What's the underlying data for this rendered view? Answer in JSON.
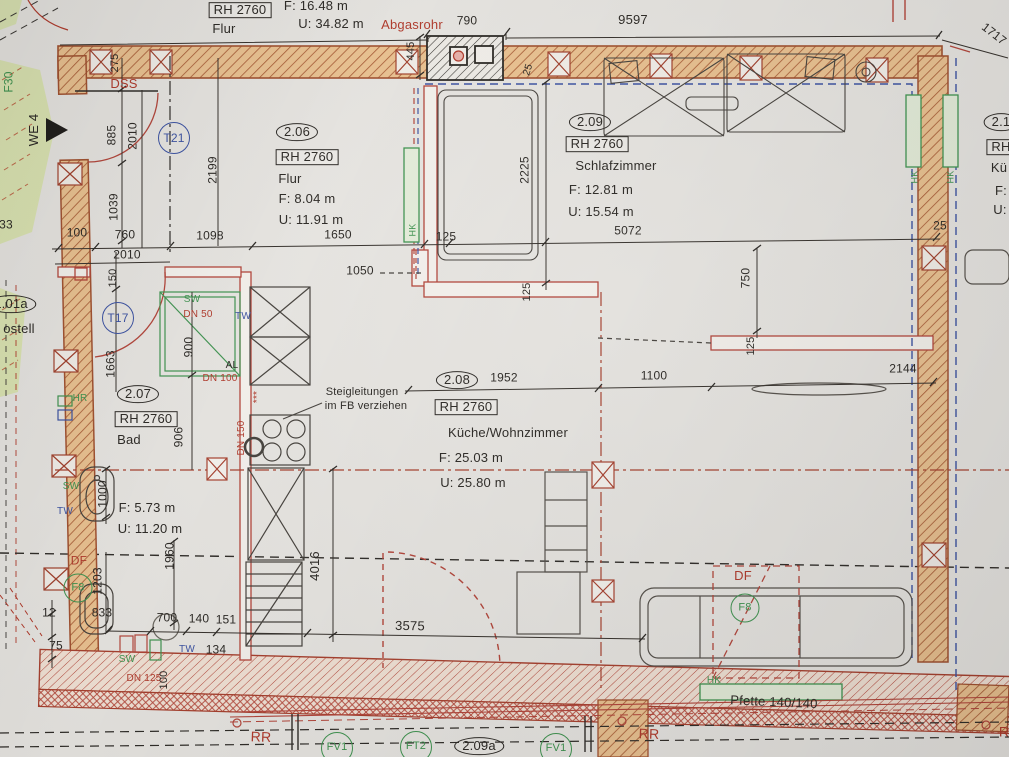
{
  "title": "Grundriss Wohnung WE 4 — Obergeschoss Ausschnitt",
  "colors": {
    "black": "#2b2824",
    "red": "#b23a2b",
    "green": "#3f9450",
    "blue": "#3b52a3",
    "wallFill": "#ecc391",
    "wallStroke": "#a2512f",
    "bandFill": "#f3e3d6",
    "paper": "#e9e7e3",
    "greenArea": "#dbe5ad",
    "pink": "#eab3ab"
  },
  "rooms": [
    {
      "number": "2.06",
      "rh": "RH 2760",
      "name": "Flur",
      "area": "F: 8.04 m",
      "perimeter": "U: 11.91 m"
    },
    {
      "number": "2.07",
      "rh": "RH 2760",
      "name": "Bad",
      "area": "F: 5.73 m",
      "perimeter": "U: 11.20 m"
    },
    {
      "number": "2.08",
      "rh": "RH 2760",
      "name": "Küche/Wohnzimmer",
      "area": "F: 25.03 m",
      "perimeter": "U: 25.80 m"
    },
    {
      "number": "2.09",
      "rh": "RH 2760",
      "name": "Schlafzimmer",
      "area": "F: 12.81 m",
      "perimeter": "U: 15.54 m"
    }
  ],
  "labels": [
    {
      "n": "top-flur-rh",
      "t": "RH 2760",
      "x": 240,
      "y": 10,
      "s": 13,
      "st": "box",
      "c": "black"
    },
    {
      "n": "top-flur-name",
      "t": "Flur",
      "x": 224,
      "y": 29,
      "s": 13,
      "c": "black"
    },
    {
      "n": "top-flur-area",
      "t": "F: 16.48 m",
      "x": 316,
      "y": 6,
      "s": 13,
      "c": "black"
    },
    {
      "n": "top-flur-perimeter",
      "t": "U: 34.82 m",
      "x": 331,
      "y": 24,
      "s": 13,
      "c": "black"
    },
    {
      "n": "abgasrohr-label",
      "t": "Abgasrohr",
      "x": 412,
      "y": 25,
      "s": 13,
      "c": "red"
    },
    {
      "n": "dim-790",
      "t": "790",
      "x": 467,
      "y": 21,
      "s": 12,
      "c": "black"
    },
    {
      "n": "dim-9597",
      "t": "9597",
      "x": 633,
      "y": 20,
      "s": 13,
      "c": "black"
    },
    {
      "n": "dim-1717",
      "t": "1717",
      "x": 994,
      "y": 34,
      "s": 12,
      "r": 38,
      "c": "black"
    },
    {
      "n": "dim-445",
      "t": "445",
      "x": 412,
      "y": 51,
      "s": 11,
      "r": -90,
      "c": "black"
    },
    {
      "n": "dim-25-chimney",
      "t": "25",
      "x": 529,
      "y": 70,
      "s": 10,
      "r": -72,
      "c": "black"
    },
    {
      "n": "dss-label",
      "t": "DSS",
      "x": 124,
      "y": 84,
      "s": 13,
      "c": "red"
    },
    {
      "n": "f30-label",
      "t": "F30",
      "x": 9,
      "y": 82,
      "s": 12,
      "r": -90,
      "c": "green"
    },
    {
      "n": "we4-label",
      "t": "WE 4",
      "x": 34,
      "y": 130,
      "s": 13,
      "r": -90,
      "c": "black"
    },
    {
      "n": "door-tag-t21",
      "t": "T21",
      "x": 174,
      "y": 138,
      "s": 12,
      "st": "circ",
      "c": "blue"
    },
    {
      "n": "dim-275",
      "t": "275",
      "x": 116,
      "y": 63,
      "s": 11,
      "r": -90,
      "c": "black"
    },
    {
      "n": "dim-885",
      "t": "885",
      "x": 112,
      "y": 135,
      "s": 12,
      "r": -90,
      "c": "black"
    },
    {
      "n": "dim-2010-v",
      "t": "2010",
      "x": 133,
      "y": 136,
      "s": 12,
      "r": -90,
      "c": "black"
    },
    {
      "n": "dim-1039",
      "t": "1039",
      "x": 114,
      "y": 207,
      "s": 12,
      "r": -90,
      "c": "black"
    },
    {
      "n": "dim-2199",
      "t": "2199",
      "x": 213,
      "y": 170,
      "s": 12,
      "r": -90,
      "c": "black"
    },
    {
      "n": "dim-100",
      "t": "100",
      "x": 77,
      "y": 233,
      "s": 12,
      "c": "black"
    },
    {
      "n": "dim-760",
      "t": "760",
      "x": 125,
      "y": 235,
      "s": 12,
      "c": "black"
    },
    {
      "n": "dim-2010-h",
      "t": "2010",
      "x": 127,
      "y": 255,
      "s": 12,
      "c": "black"
    },
    {
      "n": "dim-1098",
      "t": "1098",
      "x": 210,
      "y": 236,
      "s": 12,
      "c": "black"
    },
    {
      "n": "dim-1650",
      "t": "1650",
      "x": 338,
      "y": 235,
      "s": 12,
      "c": "black"
    },
    {
      "n": "dim-125-a",
      "t": "125",
      "x": 446,
      "y": 237,
      "s": 12,
      "c": "black"
    },
    {
      "n": "dim-5072",
      "t": "5072",
      "x": 628,
      "y": 231,
      "s": 12,
      "c": "black"
    },
    {
      "n": "dim-25-right",
      "t": "25",
      "x": 940,
      "y": 226,
      "s": 12,
      "c": "black"
    },
    {
      "n": "room-206-number",
      "t": "2.06",
      "x": 297,
      "y": 132,
      "s": 13,
      "st": "oval",
      "c": "black"
    },
    {
      "n": "room-206-rh",
      "t": "RH 2760",
      "x": 307,
      "y": 157,
      "s": 13,
      "st": "box",
      "c": "black"
    },
    {
      "n": "room-206-name",
      "t": "Flur",
      "x": 290,
      "y": 179,
      "s": 13,
      "c": "black"
    },
    {
      "n": "room-206-area",
      "t": "F: 8.04 m",
      "x": 307,
      "y": 199,
      "s": 13,
      "c": "black"
    },
    {
      "n": "room-206-perimeter",
      "t": "U: 11.91 m",
      "x": 311,
      "y": 220,
      "s": 13,
      "c": "black"
    },
    {
      "n": "hk-flur-label",
      "t": "HK",
      "x": 413,
      "y": 230,
      "s": 9,
      "r": -90,
      "c": "green"
    },
    {
      "n": "room-209-number",
      "t": "2.09",
      "x": 590,
      "y": 122,
      "s": 13,
      "st": "oval",
      "c": "black"
    },
    {
      "n": "room-209-rh",
      "t": "RH 2760",
      "x": 597,
      "y": 144,
      "s": 13,
      "st": "box",
      "c": "black"
    },
    {
      "n": "room-209-name",
      "t": "Schlafzimmer",
      "x": 616,
      "y": 166,
      "s": 13,
      "c": "black"
    },
    {
      "n": "room-209-area",
      "t": "F: 12.81 m",
      "x": 601,
      "y": 190,
      "s": 13,
      "c": "black"
    },
    {
      "n": "room-209-perimeter",
      "t": "U: 15.54 m",
      "x": 601,
      "y": 212,
      "s": 13,
      "c": "black"
    },
    {
      "n": "dim-2225",
      "t": "2225",
      "x": 525,
      "y": 170,
      "s": 12,
      "r": -90,
      "c": "black"
    },
    {
      "n": "dim-125-b",
      "t": "125",
      "x": 528,
      "y": 292,
      "s": 11,
      "r": -90,
      "c": "black"
    },
    {
      "n": "dim-1050",
      "t": "1050",
      "x": 360,
      "y": 271,
      "s": 12,
      "c": "black"
    },
    {
      "n": "dim-150",
      "t": "150",
      "x": 114,
      "y": 278,
      "s": 11,
      "r": -90,
      "c": "black"
    },
    {
      "n": "door-tag-t17",
      "t": "T17",
      "x": 118,
      "y": 318,
      "s": 12,
      "st": "circ",
      "c": "blue"
    },
    {
      "n": "dim-1663",
      "t": "1663",
      "x": 111,
      "y": 364,
      "s": 12,
      "r": -90,
      "c": "black"
    },
    {
      "n": "neighbor-room-101a",
      "t": "1.01a",
      "x": 11,
      "y": 304,
      "s": 13,
      "st": "oval",
      "c": "black"
    },
    {
      "n": "neighbor-room-name",
      "t": "ostell",
      "x": 19,
      "y": 329,
      "s": 13,
      "c": "black"
    },
    {
      "n": "dim-33-partial",
      "t": "33",
      "x": 6,
      "y": 225,
      "s": 12,
      "c": "black"
    },
    {
      "n": "shower-sw-label",
      "t": "SW",
      "x": 192,
      "y": 300,
      "s": 10,
      "c": "green"
    },
    {
      "n": "shower-dn50-label",
      "t": "DN 50",
      "x": 198,
      "y": 315,
      "s": 10,
      "c": "red"
    },
    {
      "n": "shower-tw-label",
      "t": "TW",
      "x": 243,
      "y": 317,
      "s": 10,
      "c": "blue"
    },
    {
      "n": "dim-900",
      "t": "900",
      "x": 189,
      "y": 347,
      "s": 12,
      "r": -90,
      "c": "black"
    },
    {
      "n": "al-label",
      "t": "AL",
      "x": 232,
      "y": 366,
      "s": 10,
      "c": "black"
    },
    {
      "n": "dn100-label",
      "t": "DN 100",
      "x": 220,
      "y": 379,
      "s": 10,
      "c": "red"
    },
    {
      "n": "dim-906",
      "t": "906",
      "x": 179,
      "y": 437,
      "s": 12,
      "r": -90,
      "c": "black"
    },
    {
      "n": "dn150-label",
      "t": "DN 150",
      "x": 242,
      "y": 438,
      "s": 10,
      "r": -90,
      "c": "red"
    },
    {
      "n": "riser-stars",
      "t": "***",
      "x": 258,
      "y": 397,
      "s": 10,
      "r": -90,
      "c": "red"
    },
    {
      "n": "note-steigleitungen-1",
      "t": "Steigleitungen",
      "x": 362,
      "y": 393,
      "s": 11,
      "c": "black"
    },
    {
      "n": "note-steigleitungen-2",
      "t": "im FB verziehen",
      "x": 366,
      "y": 407,
      "s": 11,
      "c": "black"
    },
    {
      "n": "room-207-number",
      "t": "2.07",
      "x": 138,
      "y": 394,
      "s": 13,
      "st": "oval",
      "c": "black"
    },
    {
      "n": "room-207-rh",
      "t": "RH 2760",
      "x": 146,
      "y": 419,
      "s": 13,
      "st": "box",
      "c": "black"
    },
    {
      "n": "room-207-name",
      "t": "Bad",
      "x": 129,
      "y": 440,
      "s": 13,
      "c": "black"
    },
    {
      "n": "room-207-area",
      "t": "F: 5.73 m",
      "x": 147,
      "y": 508,
      "s": 13,
      "c": "black"
    },
    {
      "n": "room-207-perimeter",
      "t": "U: 11.20 m",
      "x": 150,
      "y": 529,
      "s": 13,
      "c": "black"
    },
    {
      "n": "hr-label",
      "t": "HR",
      "x": 80,
      "y": 399,
      "s": 10,
      "c": "green"
    },
    {
      "n": "bad-sw-label",
      "t": "SW",
      "x": 71,
      "y": 487,
      "s": 10,
      "c": "green"
    },
    {
      "n": "bad-tw-label",
      "t": "TW",
      "x": 65,
      "y": 512,
      "s": 10,
      "c": "blue"
    },
    {
      "n": "dim-1000",
      "t": "1000",
      "x": 103,
      "y": 494,
      "s": 12,
      "r": -90,
      "c": "black"
    },
    {
      "n": "room-208-number",
      "t": "2.08",
      "x": 457,
      "y": 380,
      "s": 13,
      "st": "oval",
      "c": "black"
    },
    {
      "n": "room-208-rh",
      "t": "RH 2760",
      "x": 466,
      "y": 407,
      "s": 13,
      "st": "box",
      "c": "black"
    },
    {
      "n": "room-208-name",
      "t": "Küche/Wohnzimmer",
      "x": 508,
      "y": 433,
      "s": 13,
      "c": "black"
    },
    {
      "n": "room-208-area",
      "t": "F: 25.03 m",
      "x": 471,
      "y": 458,
      "s": 13,
      "c": "black"
    },
    {
      "n": "room-208-perimeter",
      "t": "U: 25.80 m",
      "x": 473,
      "y": 483,
      "s": 13,
      "c": "black"
    },
    {
      "n": "dim-1952",
      "t": "1952",
      "x": 504,
      "y": 378,
      "s": 12,
      "c": "black"
    },
    {
      "n": "dim-1100",
      "t": "1100",
      "x": 654,
      "y": 376,
      "s": 12,
      "c": "black"
    },
    {
      "n": "dim-2144",
      "t": "2144",
      "x": 903,
      "y": 369,
      "s": 12,
      "c": "black"
    },
    {
      "n": "dim-750",
      "t": "750",
      "x": 746,
      "y": 278,
      "s": 12,
      "r": -90,
      "c": "black"
    },
    {
      "n": "dim-125-c",
      "t": "125",
      "x": 752,
      "y": 346,
      "s": 11,
      "r": -90,
      "c": "black"
    },
    {
      "n": "df-left-label",
      "t": "DF",
      "x": 79,
      "y": 561,
      "s": 12,
      "c": "red"
    },
    {
      "n": "window-tag-f8-left",
      "t": "F8",
      "x": 78,
      "y": 588,
      "s": 11,
      "st": "circ-sm",
      "c": "green"
    },
    {
      "n": "dim-1203",
      "t": "1203",
      "x": 98,
      "y": 581,
      "s": 12,
      "r": -90,
      "c": "black"
    },
    {
      "n": "dim-1960",
      "t": "1960",
      "x": 170,
      "y": 556,
      "s": 12,
      "r": -90,
      "c": "black"
    },
    {
      "n": "dim-833",
      "t": "833",
      "x": 102,
      "y": 613,
      "s": 12,
      "c": "black"
    },
    {
      "n": "dim-12",
      "t": "12",
      "x": 49,
      "y": 613,
      "s": 12,
      "c": "black"
    },
    {
      "n": "dim-75",
      "t": "75",
      "x": 56,
      "y": 646,
      "s": 12,
      "c": "black"
    },
    {
      "n": "dim-700",
      "t": "700",
      "x": 167,
      "y": 618,
      "s": 12,
      "c": "black"
    },
    {
      "n": "dim-140",
      "t": "140",
      "x": 199,
      "y": 619,
      "s": 12,
      "c": "black"
    },
    {
      "n": "dim-151",
      "t": "151",
      "x": 226,
      "y": 620,
      "s": 12,
      "c": "black"
    },
    {
      "n": "dim-134",
      "t": "134",
      "x": 216,
      "y": 650,
      "s": 12,
      "c": "black"
    },
    {
      "n": "bottom-tw-label",
      "t": "TW",
      "x": 187,
      "y": 650,
      "s": 10,
      "c": "blue"
    },
    {
      "n": "bottom-sw-label",
      "t": "SW",
      "x": 127,
      "y": 660,
      "s": 10,
      "c": "green"
    },
    {
      "n": "dn125-label",
      "t": "DN 125",
      "x": 144,
      "y": 679,
      "s": 10,
      "c": "red"
    },
    {
      "n": "dim-100-b",
      "t": "100",
      "x": 165,
      "y": 680,
      "s": 11,
      "r": -90,
      "c": "black"
    },
    {
      "n": "dim-4016",
      "t": "4016",
      "x": 315,
      "y": 566,
      "s": 13,
      "r": -90,
      "c": "black"
    },
    {
      "n": "dim-3575",
      "t": "3575",
      "x": 410,
      "y": 626,
      "s": 13,
      "r": 1,
      "c": "black"
    },
    {
      "n": "df-right-label",
      "t": "DF",
      "x": 743,
      "y": 576,
      "s": 13,
      "c": "red"
    },
    {
      "n": "window-tag-f8-right",
      "t": "F8",
      "x": 745,
      "y": 608,
      "s": 11,
      "st": "circ-sm",
      "c": "green"
    },
    {
      "n": "hk-right-inner-label",
      "t": "HK",
      "x": 915,
      "y": 177,
      "s": 9,
      "r": -90,
      "c": "green"
    },
    {
      "n": "hk-right-outer-label",
      "t": "HK",
      "x": 951,
      "y": 177,
      "s": 9,
      "r": -90,
      "c": "green"
    },
    {
      "n": "hk-sofa-label",
      "t": "HK",
      "x": 714,
      "y": 681,
      "s": 10,
      "c": "green"
    },
    {
      "n": "pfette-label",
      "t": "Pfette 140/140",
      "x": 774,
      "y": 702,
      "s": 13,
      "r": 2.5,
      "c": "black"
    },
    {
      "n": "rr-label-1",
      "t": "RR",
      "x": 261,
      "y": 737,
      "s": 14,
      "r": 2,
      "c": "red"
    },
    {
      "n": "rr-label-2",
      "t": "RR",
      "x": 649,
      "y": 734,
      "s": 14,
      "r": 2,
      "c": "red"
    },
    {
      "n": "rr-label-3",
      "t": "R",
      "x": 1004,
      "y": 732,
      "s": 14,
      "c": "red"
    },
    {
      "n": "window-tag-fv1-a",
      "t": "FV1",
      "x": 337,
      "y": 748,
      "s": 11,
      "st": "circ",
      "c": "green"
    },
    {
      "n": "window-tag-ft2",
      "t": "FT2",
      "x": 416,
      "y": 747,
      "s": 11,
      "st": "circ",
      "c": "green"
    },
    {
      "n": "room-209a-number",
      "t": "2.09a",
      "x": 479,
      "y": 746,
      "s": 13,
      "st": "oval",
      "c": "black"
    },
    {
      "n": "window-tag-fv1-b",
      "t": "FV1",
      "x": 556,
      "y": 749,
      "s": 11,
      "st": "circ",
      "c": "green"
    },
    {
      "n": "room-right-number",
      "t": "2.1",
      "x": 1001,
      "y": 122,
      "s": 13,
      "st": "oval",
      "c": "black"
    },
    {
      "n": "room-right-rh",
      "t": "RH",
      "x": 1001,
      "y": 147,
      "s": 13,
      "st": "box",
      "c": "black"
    },
    {
      "n": "room-right-name",
      "t": "Kü",
      "x": 999,
      "y": 168,
      "s": 13,
      "c": "black"
    },
    {
      "n": "room-right-area",
      "t": "F:",
      "x": 1001,
      "y": 191,
      "s": 13,
      "c": "black"
    },
    {
      "n": "room-right-perimeter",
      "t": "U:",
      "x": 1000,
      "y": 210,
      "s": 13,
      "c": "black"
    }
  ]
}
